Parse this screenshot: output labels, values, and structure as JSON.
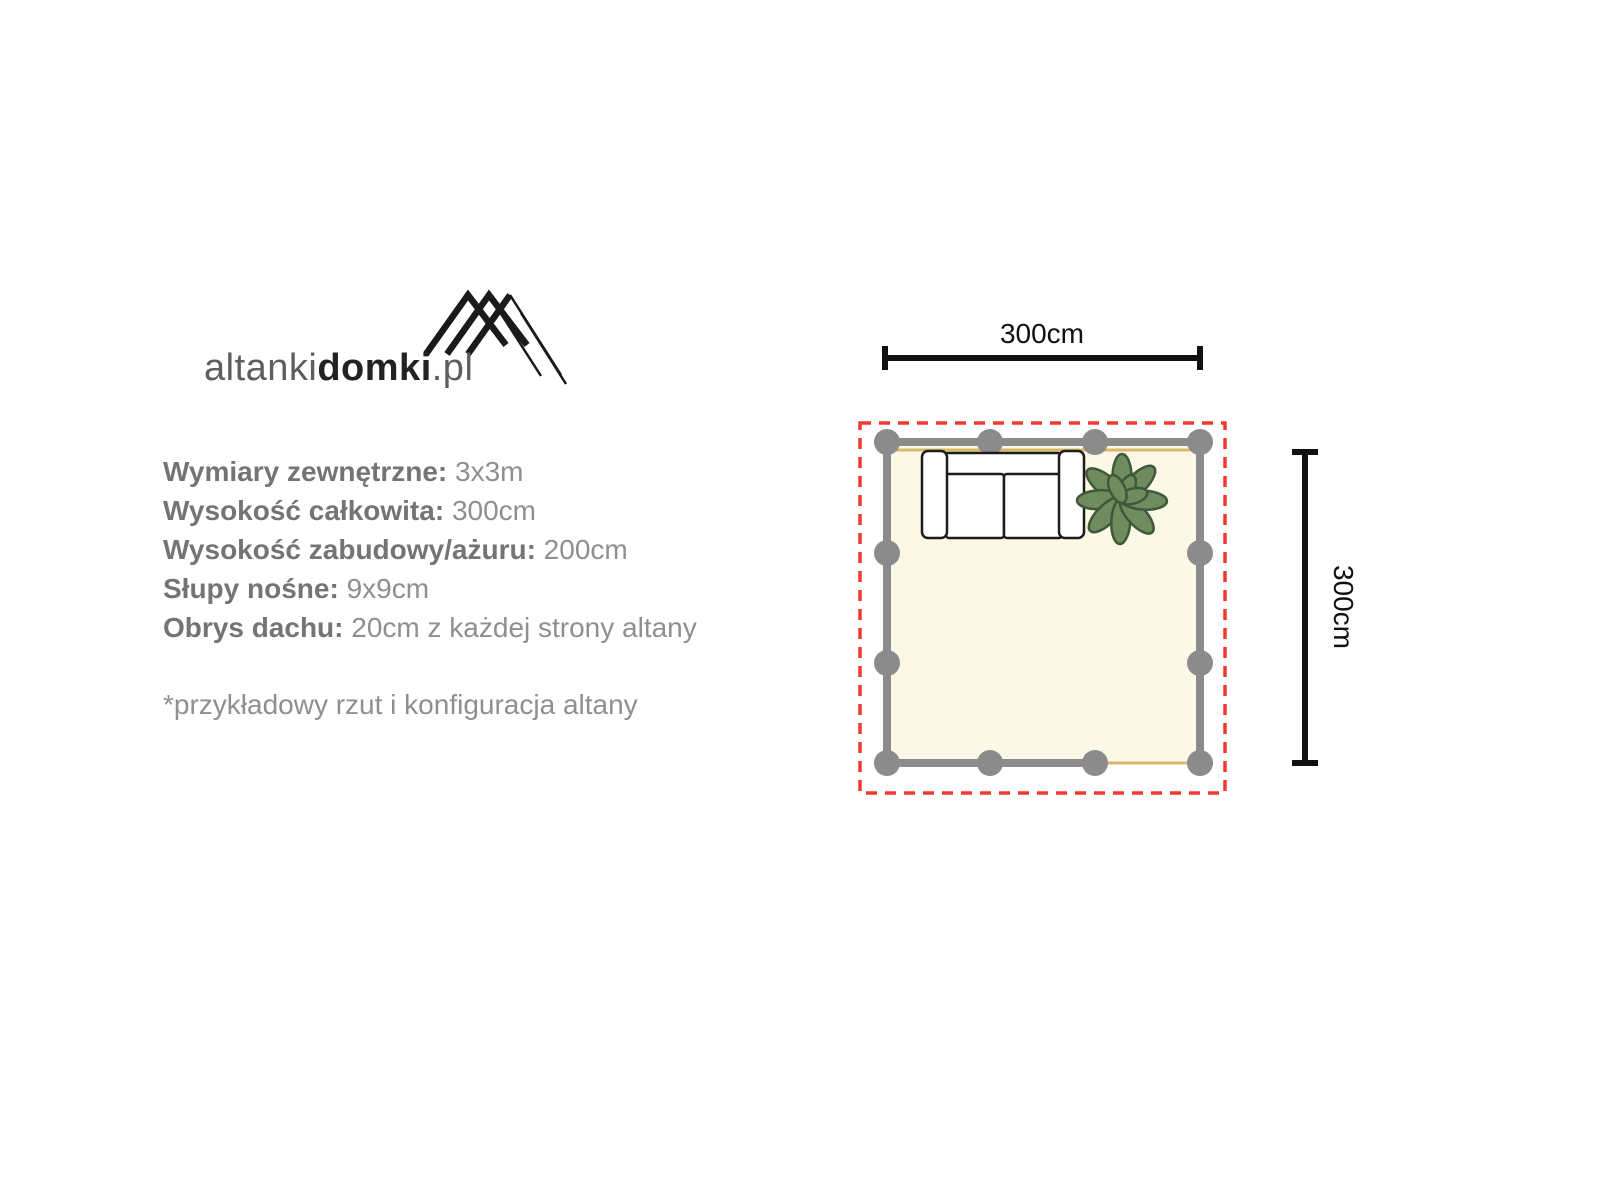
{
  "logo": {
    "text_regular": "altanki",
    "text_bold": "domki",
    "text_suffix": ".pl",
    "regular_color": "#5e5e5e",
    "bold_color": "#222222",
    "icon_name": "mountain-peaks-icon",
    "icon_color": "#1a1a1a"
  },
  "specs": {
    "items": [
      {
        "label": "Wymiary zewnętrzne:",
        "value": "3x3m"
      },
      {
        "label": "Wysokość całkowita:",
        "value": "300cm"
      },
      {
        "label": "Wysokość zabudowy/ażuru:",
        "value": "200cm"
      },
      {
        "label": "Słupy nośne:",
        "value": "9x9cm"
      },
      {
        "label": "Obrys dachu:",
        "value": "20cm z każdej strony altany"
      }
    ],
    "footnote": "*przykładowy rzut i konfiguracja altany",
    "label_color": "#747474",
    "value_color": "#8f8f8f"
  },
  "diagram": {
    "width_label": "300cm",
    "height_label": "300cm",
    "colors": {
      "roof_outline": "#ee3a31",
      "wall": "#8b8b8b",
      "floor": "#fbf8e7",
      "accent": "#d9b869",
      "dimension": "#111111",
      "furniture_outline": "#1c1c1c",
      "furniture_fill": "#ffffff",
      "plant_fill": "#6f8c5f",
      "plant_stroke": "#40583a"
    }
  }
}
